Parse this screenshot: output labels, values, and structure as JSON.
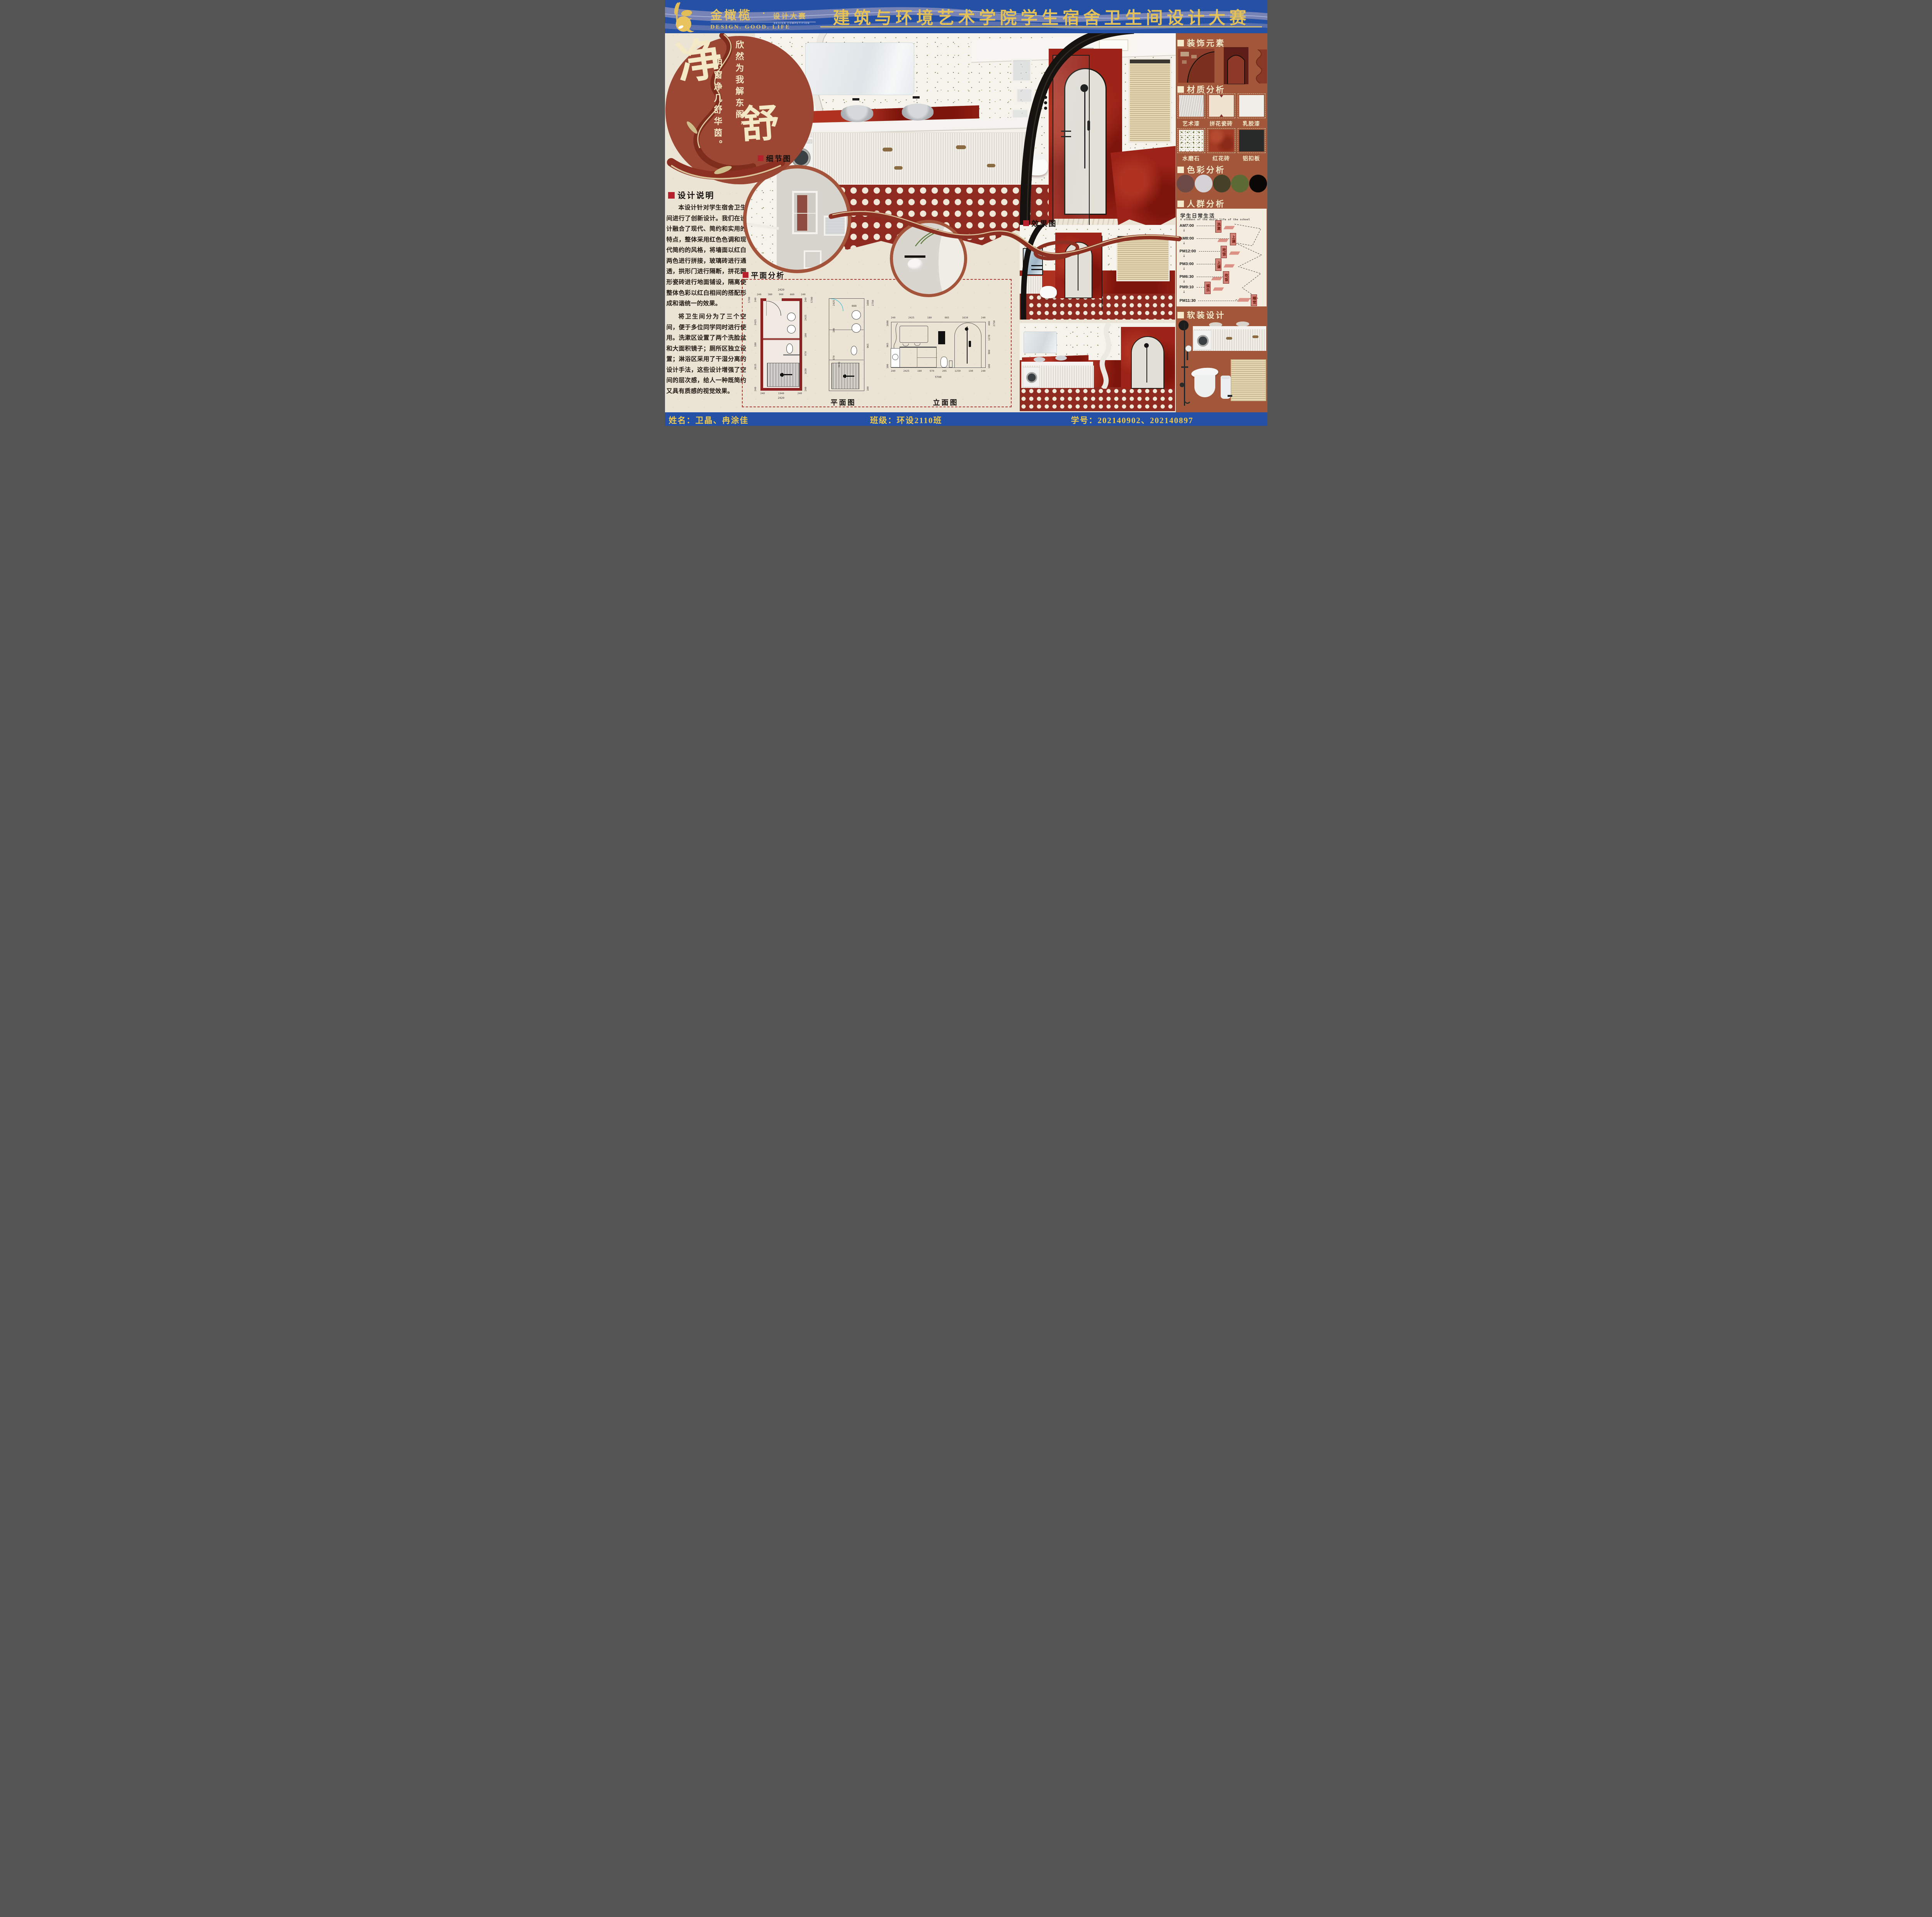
{
  "header": {
    "logo": {
      "brand": "金橄榄",
      "dot": "·",
      "sub": "设计大赛",
      "sub_en": "DESIGN COMPETITION",
      "tagline": "DESIGN. GOOD. LIFE"
    },
    "title": "建筑与环境艺术学院学生宿舍卫生间设计大赛"
  },
  "hero": {
    "char_primary": "净",
    "char_secondary": "舒",
    "verse_right": "欣然为我解东阁，",
    "verse_left": "明窗净几舒华茵。"
  },
  "notes": {
    "heading": "设计说明",
    "para1": "本设计针对学生宿舍卫生间进行了创新设计。我们在设计融合了现代、简约和实用的特点，整体采用红色色调和现代简约的风格，将墙面以红白两色进行拼接，玻璃砖进行通透，拱形门进行隔断，拼花圆形瓷砖进行地面铺设，隔离使整体色彩以红白相间的搭配形成和谐统一的效果。",
    "para2": "将卫生间分为了三个空间，便于多位同学同时进行使用。洗漱区设置了两个洗脸盆和大面积镜子；厕所区独立设置；淋浴区采用了干湿分离的设计手法，这些设计增强了空间的层次感，给人一种既简约又具有质感的视觉效果。"
  },
  "labels": {
    "detail": "细节图",
    "plan_analysis": "平面分析",
    "render": "效果图",
    "plan_caption": "平面图",
    "elevation_caption": "立面图"
  },
  "floor_plan": {
    "top_total": "2420",
    "top_chain": [
      "240",
      "380",
      "900",
      "660",
      "240"
    ],
    "left_total": "5700",
    "left_chain": [
      "240",
      "2425",
      "180",
      "2615",
      "240"
    ],
    "right_chain": [
      "240",
      "2425",
      "180",
      "970",
      "1630",
      "240"
    ],
    "right_total": "5700",
    "bottom_chain": [
      "240",
      "1940",
      "240"
    ],
    "bottom_total": "2420"
  },
  "mid_plan": {
    "top": "660",
    "left_chain": [
      "2425",
      "180",
      "970"
    ],
    "inner": "1630",
    "right_chain": [
      "1688",
      "965",
      "100"
    ],
    "right_total": "2750"
  },
  "elevation": {
    "top_chain": [
      "240",
      "2425",
      "180",
      "985",
      "1630",
      "240"
    ],
    "left_chain": [
      "1688",
      "965",
      "100"
    ],
    "right_chain": [
      "400",
      "1270",
      "980",
      "100"
    ],
    "right_total": "2750",
    "bottom_chain": [
      "240",
      "2425",
      "180",
      "970",
      "205",
      "1250",
      "190",
      "240"
    ],
    "bottom_total": "5700"
  },
  "sidebar": {
    "decor_heading": "装饰元素",
    "materials_heading": "材质分析",
    "materials": [
      "艺术漆",
      "拼花瓷砖",
      "乳胶漆",
      "水磨石",
      "红花砖",
      "铝扣板"
    ],
    "colors_heading": "色彩分析",
    "palette": [
      "#6d4a45",
      "#d5d2d6",
      "#454128",
      "#5c6a35",
      "#0a0807"
    ],
    "crowd_heading": "人群分析",
    "schedule": {
      "title": "学生日常生活",
      "subtitle": "A student of the daily life of the school",
      "rows": [
        {
          "time": "AM7:00",
          "activity": "洗漱"
        },
        {
          "time": "AM8:00",
          "activity": "上课"
        },
        {
          "time": "PM12:00",
          "activity": "吃饭"
        },
        {
          "time": "PM3:00",
          "activity": "上课"
        },
        {
          "time": "PM6:30",
          "activity": "吃饭"
        },
        {
          "time": "PM9:10",
          "activity": "娱乐"
        },
        {
          "time": "PM11:30",
          "activity": "睡觉"
        }
      ]
    },
    "soft_heading": "软装设计"
  },
  "footer": {
    "name": "姓名：卫晶、冉涂佳",
    "class_name": "班级：环设2110班",
    "student_id": "学号：202140902、202140897"
  },
  "icons": {
    "down_arrow": "↓"
  }
}
